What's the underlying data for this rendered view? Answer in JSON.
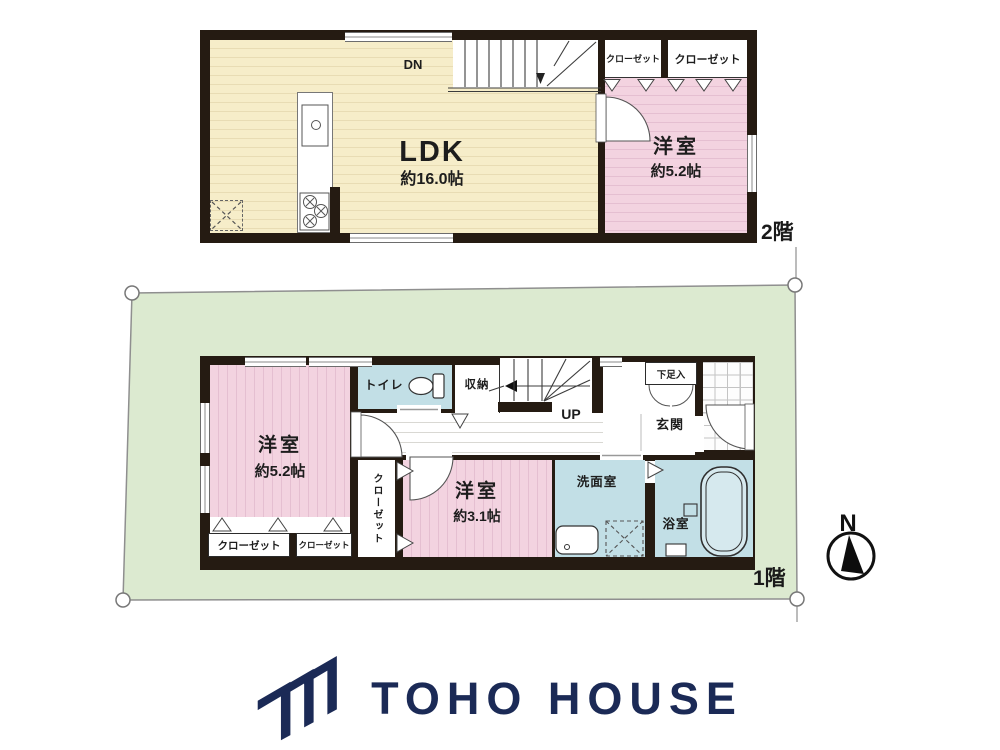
{
  "floor2": {
    "label": "2階",
    "ldk": {
      "name": "LDK",
      "area": "約16.0帖"
    },
    "bedroom": {
      "name": "洋室",
      "area": "約5.2帖"
    },
    "closet_left": "クローゼット",
    "closet_right": "クローゼット",
    "stairs_down": "DN"
  },
  "floor1": {
    "label": "1階",
    "bedroom_large": {
      "name": "洋室",
      "area": "約5.2帖"
    },
    "bedroom_small": {
      "name": "洋室",
      "area": "約3.1帖"
    },
    "toilet": "トイレ",
    "storage": "収納",
    "stairs_up": "UP",
    "shoe_cabinet": "下足入",
    "entrance": "玄関",
    "closet_vertical": "クローゼット",
    "closet_left": "クローゼット",
    "closet_right": "クローゼット",
    "washroom": "洗面室",
    "bathroom": "浴室"
  },
  "compass": {
    "north": "N"
  },
  "brand": {
    "name": "TOHO HOUSE"
  },
  "colors": {
    "wall": "#251b12",
    "ldk_floor": "#f6edc9",
    "bedroom_floor": "#f3d3e0",
    "wet_room": "#c2dfe6",
    "plot": "#dcead0",
    "brand_navy": "#1b2a56"
  }
}
